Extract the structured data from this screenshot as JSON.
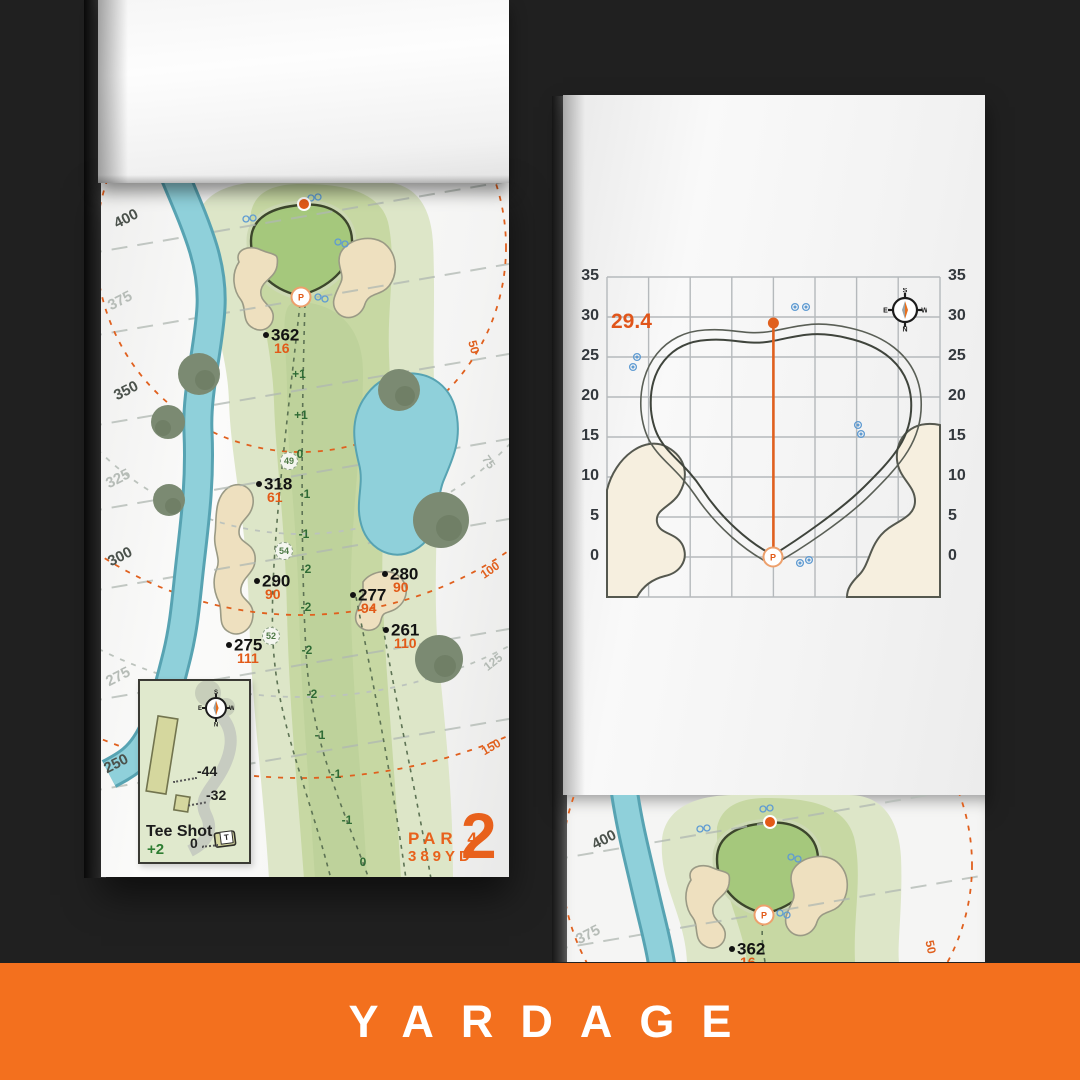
{
  "banner": {
    "label": "YARDAGE"
  },
  "colors": {
    "banner_orange": "#F3701E",
    "accent_orange": "#E25A18",
    "water_blue": "#8FD0DA",
    "fairway_green": "#C7D8A3",
    "putting_green": "#A5C87C",
    "bunker_sand": "#EEE0BF"
  },
  "hole_page": {
    "hole_number": "2",
    "par_label": "PAR 4",
    "distance_label": "389YD",
    "contour_labels": [
      {
        "t": "400"
      },
      {
        "t": "375"
      },
      {
        "t": "350"
      },
      {
        "t": "325"
      },
      {
        "t": "300"
      },
      {
        "t": "275"
      },
      {
        "t": "250"
      }
    ],
    "arc_labels": [
      {
        "t": "50"
      },
      {
        "t": "75"
      },
      {
        "t": "100"
      },
      {
        "t": "125"
      },
      {
        "t": "150"
      }
    ],
    "markers": [
      {
        "yards": "362",
        "to_green": "16"
      },
      {
        "yards": "318",
        "to_green": "61"
      },
      {
        "yards": "290",
        "to_green": "90"
      },
      {
        "yards": "280",
        "to_green": "90"
      },
      {
        "yards": "277",
        "to_green": "94"
      },
      {
        "yards": "261",
        "to_green": "110"
      },
      {
        "yards": "275",
        "to_green": "111"
      }
    ],
    "waypoints": [
      {
        "t": "49"
      },
      {
        "t": "54"
      },
      {
        "t": "52"
      }
    ],
    "elevations": [
      {
        "t": "+1"
      },
      {
        "t": "+1"
      },
      {
        "t": "0"
      },
      {
        "t": "-1"
      },
      {
        "t": "-1"
      },
      {
        "t": "-2"
      },
      {
        "t": "-2"
      },
      {
        "t": "-2"
      },
      {
        "t": "-2"
      },
      {
        "t": "-1"
      },
      {
        "t": "-1"
      },
      {
        "t": "-1"
      },
      {
        "t": "0"
      }
    ],
    "pin_label": "P",
    "tee_inset": {
      "title": "Tee Shot",
      "tee_value": "+2",
      "offsets": [
        {
          "t": "-44"
        },
        {
          "t": "-32"
        },
        {
          "t": "0"
        }
      ],
      "tee_marker": "T"
    },
    "compass": {
      "n": "N",
      "s": "S",
      "e": "E",
      "w": "W"
    }
  },
  "green_page": {
    "depth_value": "29.4",
    "pin_label": "P",
    "axis_ticks": [
      {
        "t": "35"
      },
      {
        "t": "30"
      },
      {
        "t": "25"
      },
      {
        "t": "20"
      },
      {
        "t": "15"
      },
      {
        "t": "10"
      },
      {
        "t": "5"
      },
      {
        "t": "0"
      }
    ],
    "compass": {
      "n": "N",
      "s": "S",
      "e": "E",
      "w": "W"
    }
  },
  "next_page": {
    "contour_labels": [
      {
        "t": "400"
      },
      {
        "t": "375"
      }
    ],
    "arc_label": "50",
    "marker": {
      "yards": "362",
      "to_green": "16"
    }
  }
}
